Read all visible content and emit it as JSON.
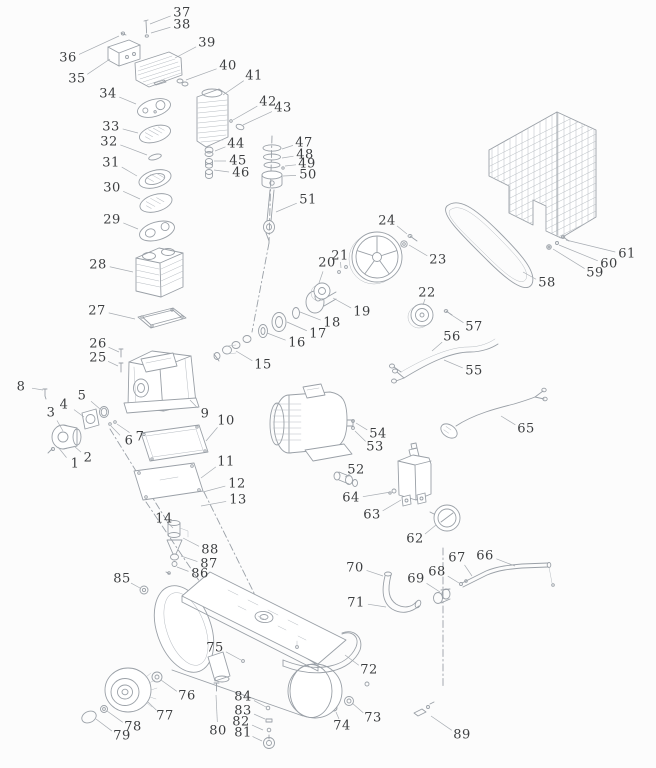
{
  "colors": {
    "background": "#fcfcfc",
    "line": "#9aa0a7",
    "line_soft": "#b7bcc2",
    "label_text": "#3c3e40",
    "leader": "#a7acb2"
  },
  "diagram": {
    "labels": [
      {
        "n": "1",
        "x": 75,
        "y": 464,
        "tx": 58,
        "ty": 447
      },
      {
        "n": "2",
        "x": 88,
        "y": 458,
        "tx": 74,
        "ty": 446
      },
      {
        "n": "3",
        "x": 51,
        "y": 413,
        "tx": 63,
        "ty": 431
      },
      {
        "n": "4",
        "x": 64,
        "y": 405,
        "tx": 84,
        "ty": 417
      },
      {
        "n": "5",
        "x": 82,
        "y": 396,
        "tx": 100,
        "ty": 409
      },
      {
        "n": "6",
        "x": 129,
        "y": 441,
        "tx": 111,
        "ty": 426
      },
      {
        "n": "7",
        "x": 140,
        "y": 437,
        "tx": 117,
        "ty": 424
      },
      {
        "n": "8",
        "x": 21,
        "y": 387,
        "tx": 43,
        "ty": 390
      },
      {
        "n": "9",
        "x": 205,
        "y": 414,
        "tx": 190,
        "ty": 400
      },
      {
        "n": "10",
        "x": 226,
        "y": 421,
        "tx": 206,
        "ty": 441
      },
      {
        "n": "11",
        "x": 226,
        "y": 462,
        "tx": 201,
        "ty": 478
      },
      {
        "n": "12",
        "x": 237,
        "y": 484,
        "tx": 203,
        "ty": 492
      },
      {
        "n": "13",
        "x": 238,
        "y": 500,
        "tx": 201,
        "ty": 506
      },
      {
        "n": "14",
        "x": 164,
        "y": 519,
        "tx": 173,
        "ty": 528
      },
      {
        "n": "15",
        "x": 263,
        "y": 365,
        "tx": 236,
        "ty": 351
      },
      {
        "n": "16",
        "x": 297,
        "y": 343,
        "tx": 267,
        "ty": 333
      },
      {
        "n": "17",
        "x": 318,
        "y": 334,
        "tx": 287,
        "ty": 322
      },
      {
        "n": "18",
        "x": 332,
        "y": 323,
        "tx": 300,
        "ty": 312
      },
      {
        "n": "19",
        "x": 362,
        "y": 312,
        "tx": 333,
        "ty": 298
      },
      {
        "n": "20",
        "x": 327,
        "y": 263,
        "tx": 319,
        "ty": 283
      },
      {
        "n": "21",
        "x": 340,
        "y": 256,
        "tx": 341,
        "ty": 268
      },
      {
        "n": "22",
        "x": 427,
        "y": 293,
        "tx": 423,
        "ty": 305
      },
      {
        "n": "23",
        "x": 438,
        "y": 260,
        "tx": 409,
        "ty": 245
      },
      {
        "n": "24",
        "x": 387,
        "y": 221,
        "tx": 407,
        "ty": 234
      },
      {
        "n": "25",
        "x": 98,
        "y": 358,
        "tx": 118,
        "ty": 366
      },
      {
        "n": "26",
        "x": 98,
        "y": 344,
        "tx": 119,
        "ty": 352
      },
      {
        "n": "27",
        "x": 97,
        "y": 311,
        "tx": 135,
        "ty": 319
      },
      {
        "n": "28",
        "x": 98,
        "y": 265,
        "tx": 133,
        "ty": 272
      },
      {
        "n": "29",
        "x": 112,
        "y": 220,
        "tx": 138,
        "ty": 229
      },
      {
        "n": "30",
        "x": 112,
        "y": 188,
        "tx": 140,
        "ty": 199
      },
      {
        "n": "31",
        "x": 111,
        "y": 163,
        "tx": 137,
        "ty": 176
      },
      {
        "n": "32",
        "x": 109,
        "y": 142,
        "tx": 147,
        "ty": 155
      },
      {
        "n": "33",
        "x": 111,
        "y": 127,
        "tx": 138,
        "ty": 133
      },
      {
        "n": "34",
        "x": 108,
        "y": 94,
        "tx": 136,
        "ty": 104
      },
      {
        "n": "35",
        "x": 77,
        "y": 79,
        "tx": 110,
        "ty": 59
      },
      {
        "n": "36",
        "x": 68,
        "y": 58,
        "tx": 119,
        "ty": 36
      },
      {
        "n": "37",
        "x": 182,
        "y": 13,
        "tx": 150,
        "ty": 24
      },
      {
        "n": "38",
        "x": 182,
        "y": 25,
        "tx": 151,
        "ty": 33
      },
      {
        "n": "39",
        "x": 207,
        "y": 43,
        "tx": 175,
        "ty": 58
      },
      {
        "n": "40",
        "x": 228,
        "y": 66,
        "tx": 186,
        "ty": 80
      },
      {
        "n": "41",
        "x": 254,
        "y": 76,
        "tx": 223,
        "ty": 95
      },
      {
        "n": "42",
        "x": 268,
        "y": 102,
        "tx": 233,
        "ty": 120
      },
      {
        "n": "43",
        "x": 283,
        "y": 108,
        "tx": 243,
        "ty": 125
      },
      {
        "n": "44",
        "x": 236,
        "y": 144,
        "tx": 215,
        "ty": 151
      },
      {
        "n": "45",
        "x": 238,
        "y": 161,
        "tx": 214,
        "ty": 161
      },
      {
        "n": "46",
        "x": 241,
        "y": 173,
        "tx": 214,
        "ty": 170
      },
      {
        "n": "47",
        "x": 304,
        "y": 143,
        "tx": 282,
        "ty": 149
      },
      {
        "n": "48",
        "x": 305,
        "y": 155,
        "tx": 282,
        "ty": 158
      },
      {
        "n": "49",
        "x": 307,
        "y": 164,
        "tx": 285,
        "ty": 166
      },
      {
        "n": "50",
        "x": 308,
        "y": 175,
        "tx": 283,
        "ty": 176
      },
      {
        "n": "51",
        "x": 308,
        "y": 200,
        "tx": 276,
        "ty": 212
      },
      {
        "n": "52",
        "x": 356,
        "y": 470,
        "tx": 345,
        "ty": 477
      },
      {
        "n": "53",
        "x": 375,
        "y": 447,
        "tx": 355,
        "ty": 431
      },
      {
        "n": "54",
        "x": 378,
        "y": 434,
        "tx": 356,
        "ty": 423
      },
      {
        "n": "55",
        "x": 474,
        "y": 371,
        "tx": 444,
        "ty": 360
      },
      {
        "n": "56",
        "x": 452,
        "y": 337,
        "tx": 432,
        "ty": 351
      },
      {
        "n": "57",
        "x": 474,
        "y": 327,
        "tx": 450,
        "ty": 314
      },
      {
        "n": "58",
        "x": 547,
        "y": 283,
        "tx": 523,
        "ty": 272
      },
      {
        "n": "59",
        "x": 595,
        "y": 273,
        "tx": 553,
        "ty": 249
      },
      {
        "n": "60",
        "x": 609,
        "y": 264,
        "tx": 559,
        "ty": 245
      },
      {
        "n": "61",
        "x": 627,
        "y": 254,
        "tx": 566,
        "ty": 240
      },
      {
        "n": "62",
        "x": 415,
        "y": 539,
        "tx": 436,
        "ty": 525
      },
      {
        "n": "63",
        "x": 372,
        "y": 515,
        "tx": 401,
        "ty": 500
      },
      {
        "n": "64",
        "x": 351,
        "y": 498,
        "tx": 391,
        "ty": 492
      },
      {
        "n": "65",
        "x": 526,
        "y": 429,
        "tx": 501,
        "ty": 416
      },
      {
        "n": "66",
        "x": 485,
        "y": 556,
        "tx": 515,
        "ty": 566
      },
      {
        "n": "67",
        "x": 457,
        "y": 558,
        "tx": 472,
        "ty": 576
      },
      {
        "n": "68",
        "x": 437,
        "y": 572,
        "tx": 459,
        "ty": 583
      },
      {
        "n": "69",
        "x": 416,
        "y": 579,
        "tx": 440,
        "ty": 592
      },
      {
        "n": "70",
        "x": 355,
        "y": 568,
        "tx": 383,
        "ty": 576
      },
      {
        "n": "71",
        "x": 356,
        "y": 603,
        "tx": 386,
        "ty": 607
      },
      {
        "n": "72",
        "x": 369,
        "y": 670,
        "tx": 345,
        "ty": 655
      },
      {
        "n": "73",
        "x": 373,
        "y": 718,
        "tx": 352,
        "ty": 703
      },
      {
        "n": "74",
        "x": 342,
        "y": 726,
        "tx": 336,
        "ty": 712
      },
      {
        "n": "75",
        "x": 215,
        "y": 648,
        "tx": 241,
        "ty": 660
      },
      {
        "n": "76",
        "x": 187,
        "y": 696,
        "tx": 161,
        "ty": 680
      },
      {
        "n": "77",
        "x": 165,
        "y": 716,
        "tx": 148,
        "ty": 702
      },
      {
        "n": "78",
        "x": 133,
        "y": 727,
        "tx": 107,
        "ty": 711
      },
      {
        "n": "79",
        "x": 122,
        "y": 736,
        "tx": 96,
        "ty": 719
      },
      {
        "n": "80",
        "x": 218,
        "y": 731,
        "tx": 216,
        "ty": 695
      },
      {
        "n": "81",
        "x": 243,
        "y": 733,
        "tx": 262,
        "ty": 741
      },
      {
        "n": "82",
        "x": 241,
        "y": 722,
        "tx": 263,
        "ty": 730
      },
      {
        "n": "83",
        "x": 243,
        "y": 711,
        "tx": 265,
        "ty": 719
      },
      {
        "n": "84",
        "x": 243,
        "y": 697,
        "tx": 266,
        "ty": 707
      },
      {
        "n": "85",
        "x": 122,
        "y": 579,
        "tx": 140,
        "ty": 588
      },
      {
        "n": "86",
        "x": 200,
        "y": 574,
        "tx": 177,
        "ty": 567
      },
      {
        "n": "87",
        "x": 209,
        "y": 564,
        "tx": 181,
        "ty": 556
      },
      {
        "n": "88",
        "x": 210,
        "y": 550,
        "tx": 183,
        "ty": 538
      },
      {
        "n": "89",
        "x": 462,
        "y": 735,
        "tx": 431,
        "ty": 716
      }
    ]
  }
}
